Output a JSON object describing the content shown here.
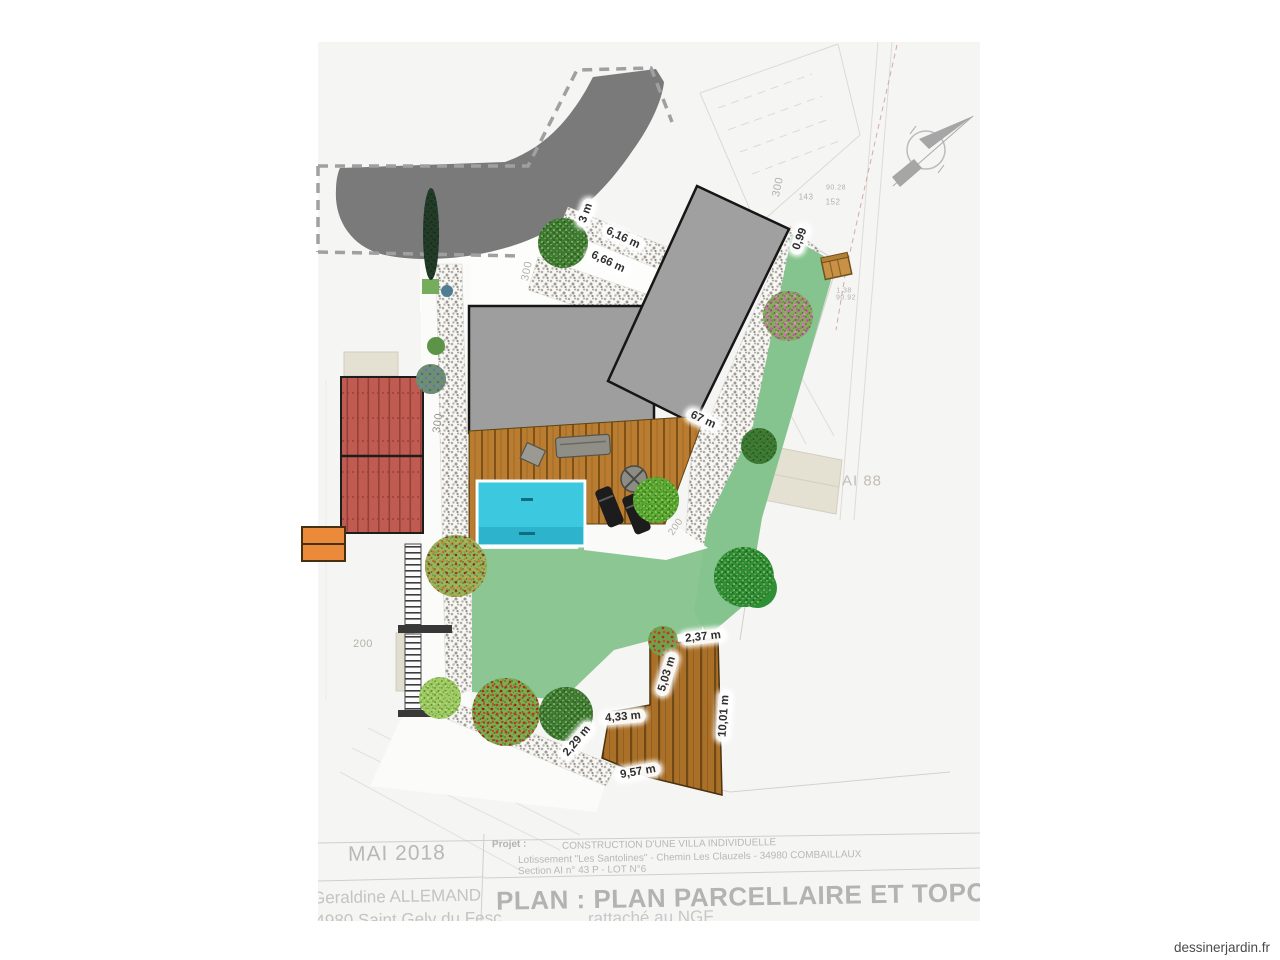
{
  "watermark": "dessinerjardin.fr",
  "parcel_label": "AI 88",
  "title_block": {
    "date": "MAI 2018",
    "owner_line1": "Geraldine ALLEMAND",
    "owner_line2": "34980 Saint Gely du Fesc",
    "project_label": "Projet :",
    "project_lines": [
      "CONSTRUCTION D'UNE VILLA INDIVIDUELLE",
      "Lotissement \"Les Santolines\" - Chemin Les Clauzels - 34980 COMBAILLAUX",
      "Section AI n° 43 P - LOT N°6"
    ],
    "plan_title": "PLAN : PLAN PARCELLAIRE ET TOPOGRAPHIQUE",
    "plan_subtitle": "rattaché au NGF"
  },
  "plan": {
    "dimension_labels": [
      {
        "text": "3 m",
        "x": 586,
        "y": 213,
        "rot": -70
      },
      {
        "text": "6,16 m",
        "x": 623,
        "y": 238,
        "rot": 25
      },
      {
        "text": "6,66 m",
        "x": 608,
        "y": 262,
        "rot": 25
      },
      {
        "text": "0,99",
        "x": 800,
        "y": 239,
        "rot": -70
      },
      {
        "text": "67 m",
        "x": 703,
        "y": 420,
        "rot": 25
      },
      {
        "text": "2,37 m",
        "x": 703,
        "y": 637,
        "rot": -6
      },
      {
        "text": "5,03 m",
        "x": 667,
        "y": 674,
        "rot": -73
      },
      {
        "text": "4,33 m",
        "x": 623,
        "y": 717,
        "rot": -5
      },
      {
        "text": "10,01 m",
        "x": 724,
        "y": 716,
        "rot": -86
      },
      {
        "text": "2,29 m",
        "x": 577,
        "y": 741,
        "rot": -50
      },
      {
        "text": "9,57 m",
        "x": 638,
        "y": 772,
        "rot": -10
      }
    ],
    "survey_labels": [
      {
        "text": "300",
        "x": 527,
        "y": 271,
        "rot": -78,
        "size": 11
      },
      {
        "text": "300",
        "x": 778,
        "y": 187,
        "rot": -78,
        "size": 11
      },
      {
        "text": "300",
        "x": 438,
        "y": 423,
        "rot": -82,
        "size": 11,
        "color": "#97948e"
      },
      {
        "text": "200",
        "x": 363,
        "y": 644,
        "rot": 0,
        "size": 11
      },
      {
        "text": "200",
        "x": 676,
        "y": 527,
        "rot": -55,
        "size": 10
      },
      {
        "text": "143",
        "x": 806,
        "y": 197,
        "rot": 0,
        "size": 8
      },
      {
        "text": "152",
        "x": 833,
        "y": 202,
        "rot": 0,
        "size": 8
      },
      {
        "text": "90.28",
        "x": 836,
        "y": 188,
        "rot": 0,
        "size": 7
      },
      {
        "text": "1.38",
        "x": 844,
        "y": 291,
        "rot": 0,
        "size": 7
      },
      {
        "text": "90.92",
        "x": 846,
        "y": 298,
        "rot": 0,
        "size": 7
      }
    ]
  },
  "colors": {
    "sheet": "#f5f5f4",
    "road": "#7a7a7a",
    "building": "#9e9e9e",
    "roof_red": "#c05b51",
    "pool": "#3cc9e0",
    "lawn": "#8cc693",
    "deck": "#b97c30",
    "gravel": "#aeada7",
    "orange": "#ec8a3c"
  }
}
